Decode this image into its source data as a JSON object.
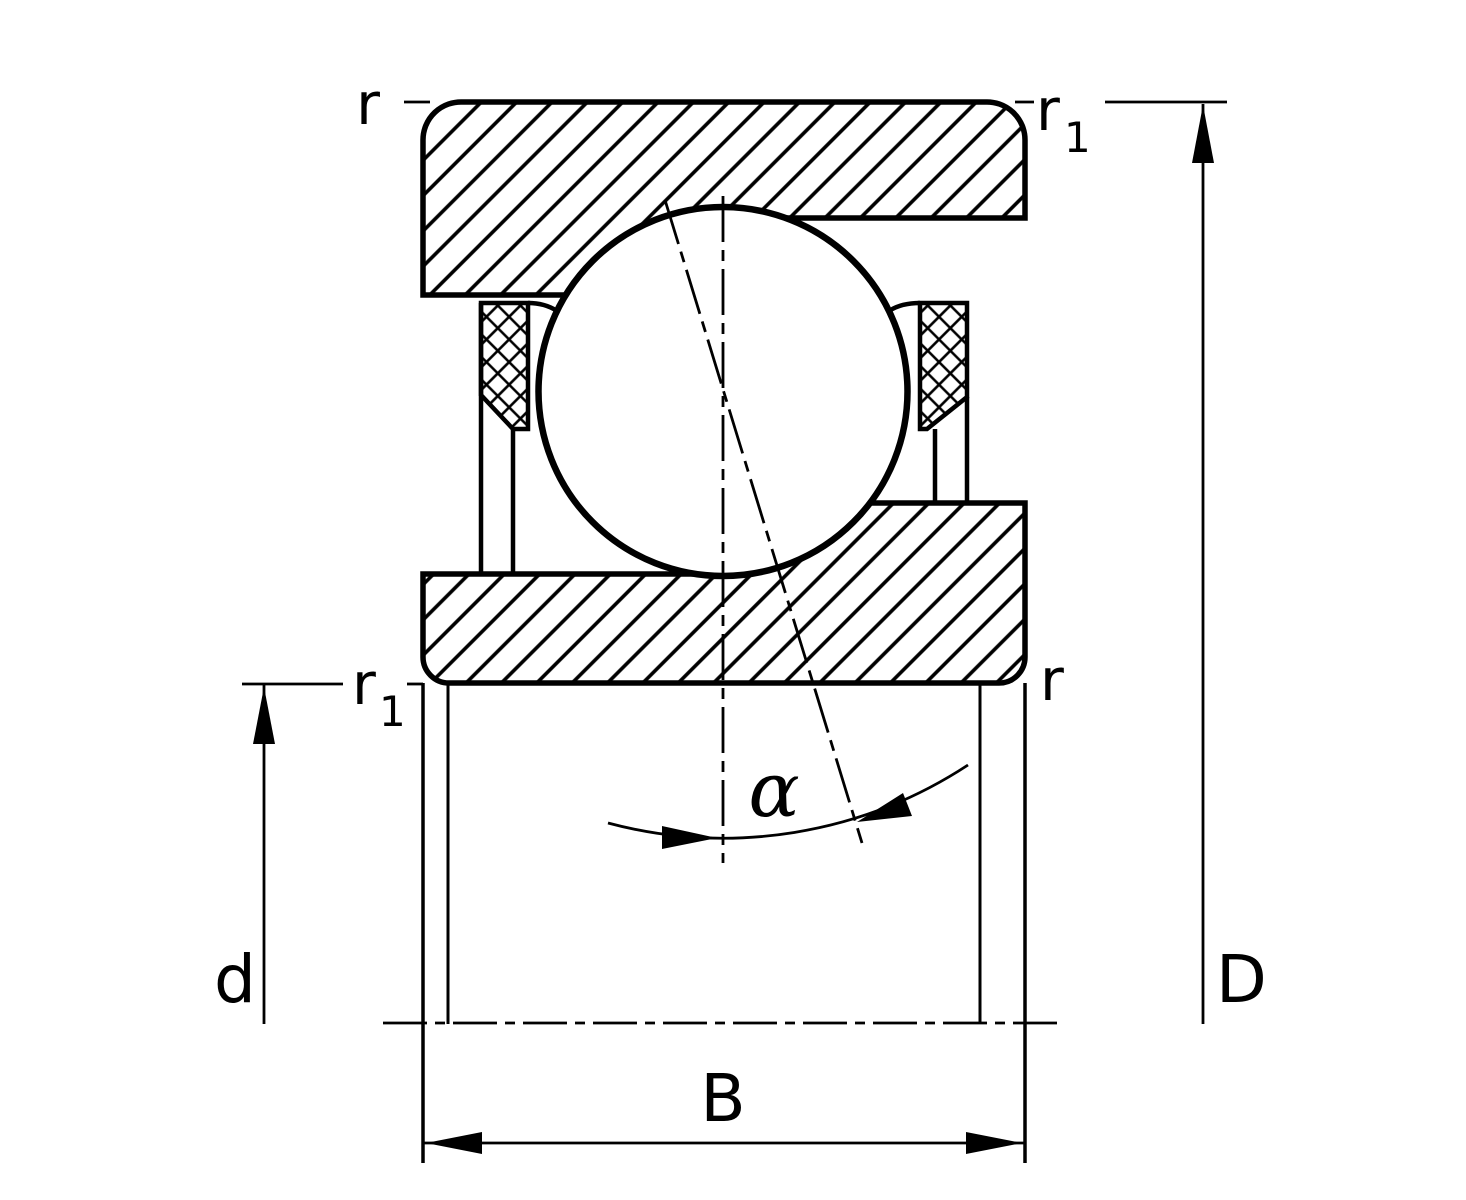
{
  "diagram": {
    "kind": "bearing cross-section drawing",
    "colors": {
      "line": "#000000",
      "background": "#ffffff"
    }
  },
  "labels": {
    "corner_top_left": "r",
    "corner_top_right": {
      "base": "r",
      "sub": "1"
    },
    "corner_mid_left": {
      "base": "r",
      "sub": "1"
    },
    "corner_mid_right": "r",
    "dim_bore": "d",
    "dim_outer": "D",
    "dim_width": "B",
    "angle": "α"
  }
}
